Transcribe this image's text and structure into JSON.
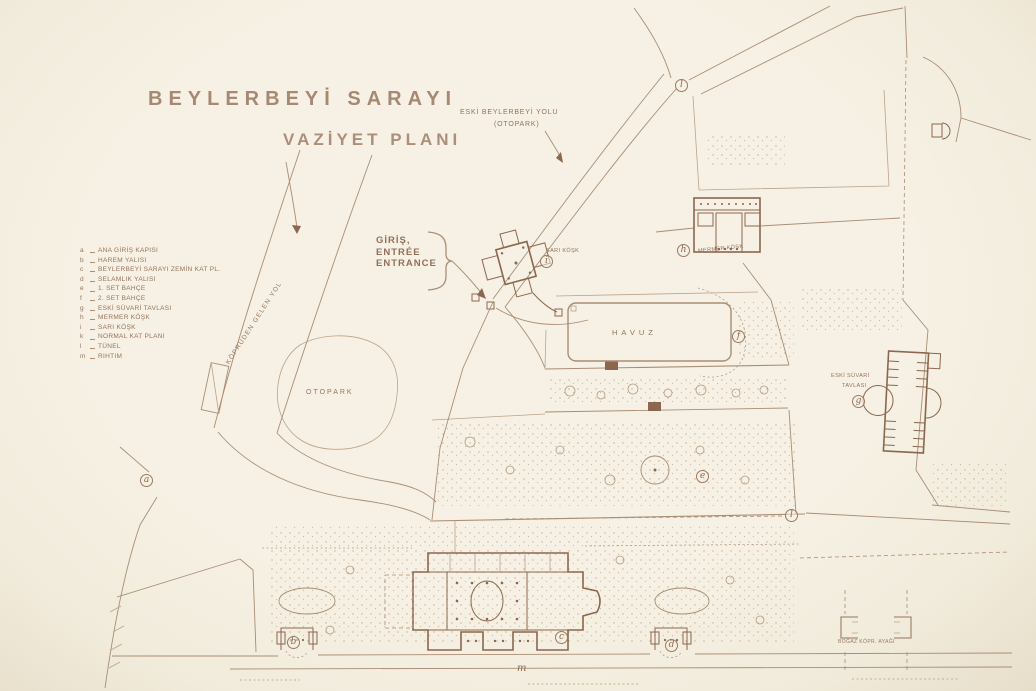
{
  "title": {
    "line1": "BEYLERBEYİ SARAYI",
    "line2": "VAZİYET PLANI"
  },
  "legend": {
    "items": [
      {
        "letter": "a",
        "label": "ANA GİRİŞ KAPISI"
      },
      {
        "letter": "b",
        "label": "HAREM YALISI"
      },
      {
        "letter": "c",
        "label": "BEYLERBEYİ SARAYI ZEMİN KAT PL."
      },
      {
        "letter": "d",
        "label": "SELAMLIK YALISI"
      },
      {
        "letter": "e",
        "label": "1. SET BAHÇE"
      },
      {
        "letter": "f",
        "label": "2. SET BAHÇE"
      },
      {
        "letter": "g",
        "label": "ESKİ SÜVARİ TAVLASI"
      },
      {
        "letter": "h",
        "label": "MERMER KÖŞK"
      },
      {
        "letter": "i",
        "label": "SARI KÖŞK"
      },
      {
        "letter": "k",
        "label": "NORMAL KAT PLANI"
      },
      {
        "letter": "l",
        "label": "TÜNEL"
      },
      {
        "letter": "m",
        "label": "RIHTIM"
      }
    ]
  },
  "labels": {
    "old_road_line1": "ESKİ BEYLERBEYİ YOLU",
    "old_road_line2": "(OTOPARK)",
    "entrance_tr": "GİRİŞ,",
    "entrance_fr": "ENTRÉE",
    "entrance_en": "ENTRANCE",
    "bridge_road": "KÖPRÜDEN GELEN YOL",
    "parking": "OTOPARK",
    "yellow_kiosk": "SARI KÖŞK",
    "marble_kiosk": "MERMER KÖŞK",
    "pool": "HAVUZ",
    "stable_line1": "ESKİ SÜVARİ",
    "stable_line2": "TAVLASI",
    "bridge_pier": "BOĞAZ KÖPR. AYAĞI",
    "quay_letter": "m"
  },
  "markers": {
    "a": "a",
    "b": "b",
    "c": "c",
    "d": "d",
    "e": "e",
    "f": "f",
    "g": "g",
    "h": "h",
    "i": "i",
    "l_top": "l",
    "l_tunnel": "l"
  },
  "colors": {
    "paper": "#f4efe2",
    "ink": "#9b7b62",
    "ink_dark": "#8a674e",
    "ink_light": "#bda68e"
  }
}
